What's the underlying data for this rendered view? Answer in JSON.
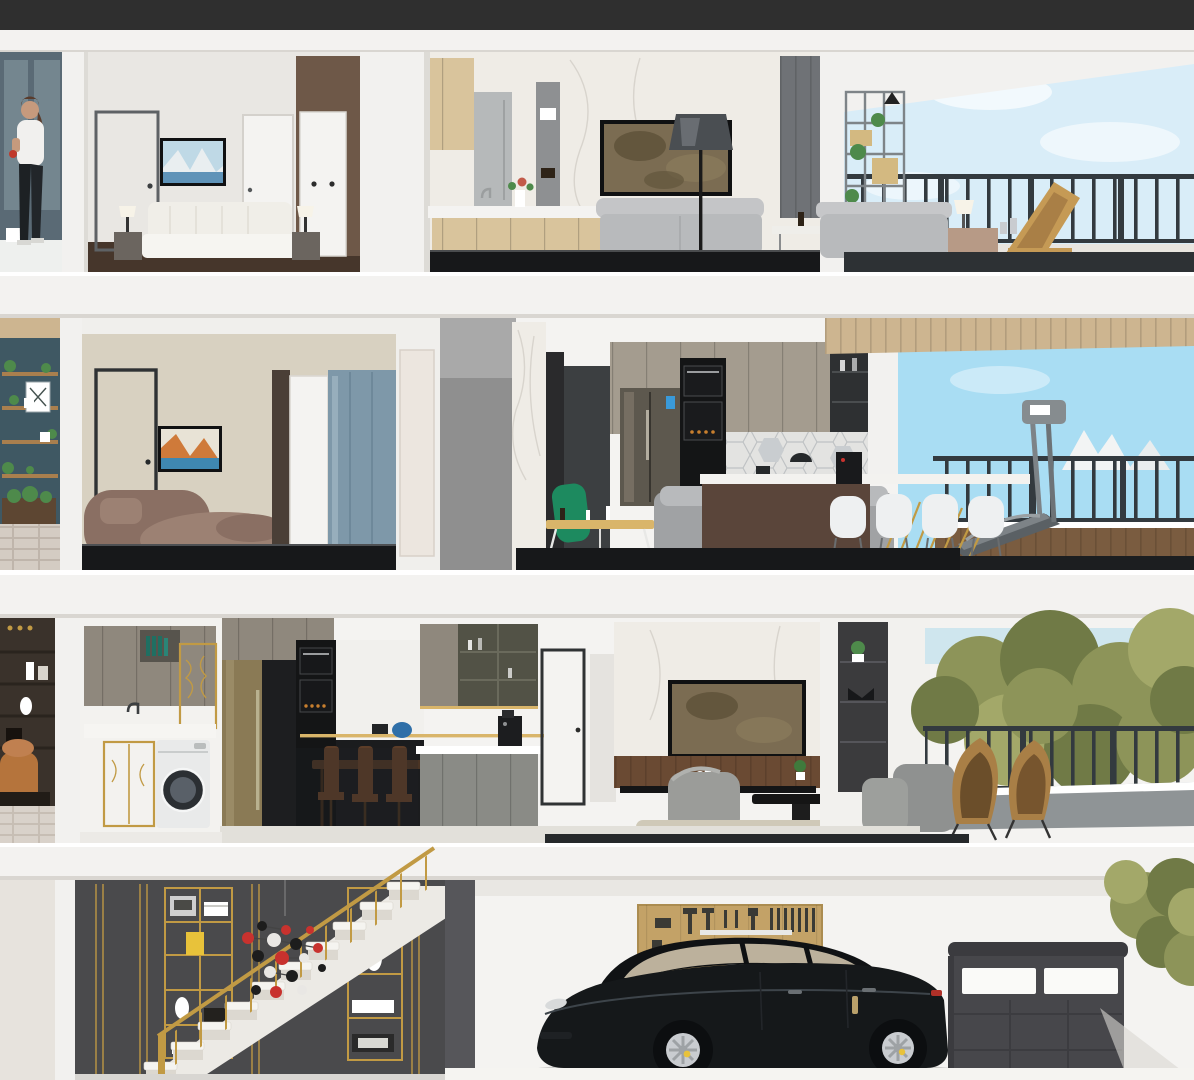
{
  "window": {
    "top_bar_color": "#2f2f2f"
  },
  "scene": {
    "type": "3d-dollhouse-cross-section",
    "description_tag": "four-storey-home-cutaway-render",
    "floors": [
      {
        "level": 4,
        "label": "top-floor",
        "rooms": [
          "bedroom",
          "open-kitchen-living-room",
          "balcony-lounge"
        ],
        "objects": [
          "interior-door-gray",
          "wall-tv-landscape",
          "double-bed",
          "nightstand-lamps",
          "interior-door-white",
          "wardrobe",
          "kitchen-island",
          "living-room-tv",
          "floor-lamp",
          "gray-sofa",
          "media-table",
          "plant-shelf",
          "papasan-chair",
          "blue-pillows",
          "side-table-lamp",
          "rattan-lounger",
          "balcony-railing",
          "sky"
        ]
      },
      {
        "level": 3,
        "label": "second-floor",
        "rooms": [
          "lounge-bedroom",
          "kitchen-dining",
          "fitness-balcony"
        ],
        "objects": [
          "plant-wall-shelves",
          "gray-door",
          "wall-tv-canyon",
          "curved-mauve-sofa",
          "white-closet",
          "blue-cabinet",
          "marble-pillar",
          "fridge",
          "oven-column",
          "hexagon-backsplash",
          "kitchen-island-dark",
          "green-accent-chair",
          "gold-coffee-table",
          "gray-sofa-blue-pillow",
          "white-dining-chairs",
          "coffee-machine",
          "treadmill",
          "balcony-railing",
          "wood-planter",
          "sky"
        ]
      },
      {
        "level": 2,
        "label": "third-floor",
        "rooms": [
          "laundry-room",
          "kitchen-dining",
          "living-room",
          "tree-view-balcony"
        ],
        "objects": [
          "study-shelf-exterior",
          "laundry-cabinets",
          "gold-framed-cabinets",
          "washing-machine",
          "brass-fridge",
          "oven-column",
          "gold-rail",
          "dining-table-wood",
          "olive-glass-cabinets",
          "coffee-machine",
          "marble-tv-wall",
          "living-room-tv",
          "wood-wainscot",
          "gray-armchair",
          "black-coffee-table",
          "beige-rug",
          "display-cabinet",
          "rattan-egg-chairs",
          "balcony-railing",
          "trees"
        ]
      },
      {
        "level": 1,
        "label": "ground-floor",
        "rooms": [
          "stair-hall",
          "garage"
        ],
        "objects": [
          "paneled-dark-wall",
          "gold-etagere-left",
          "gold-etagere-right",
          "white-staircase",
          "gold-handrail",
          "molecule-sculpture",
          "tool-pegboard-wall",
          "red-stool",
          "black-sedan-car",
          "garage-door-with-windows",
          "tree-foliage"
        ]
      }
    ]
  },
  "palette": {
    "topbar": "#2f2f2f",
    "slab": "#f3f2f0",
    "slab_edge": "#d9d6d1",
    "wall_light": "#eae8e4",
    "wall_white": "#f4f3f1",
    "wall_beige": "#d8d1c1",
    "wall_gray": "#8f8f8f",
    "marble": "#efece6",
    "marble_vein": "#d8d4cd",
    "column": "#f2f1ef",
    "column_shade": "#dddbd6",
    "floor_brown": "#46362b",
    "floor_black": "#17181a",
    "floor_tile": "#2d3134",
    "floor_light": "#e2e0da",
    "sky_pale": "#d9edf8",
    "sky_blue": "#a9ddf3",
    "sky_haze": "#cfe6ee",
    "rail": "#333a3f",
    "wood_light": "#d9c49c",
    "wood_soffit": "#cdb590",
    "teal_wall": "#3f5863",
    "brick": "#d4ccc3",
    "brick_line": "#bfb5ab",
    "shelf_wood": "#a97f4e",
    "plant_green": "#4e8a4b",
    "study_brown": "#3a322b",
    "caramel": "#b5743c",
    "door_gray": "#949a9d",
    "door_frame": "#5e6265",
    "frame_dark": "#2f3234",
    "tv_frame": "#101112",
    "tv_blur": "#7b6c52",
    "tv_blur_dark": "#5e5138",
    "mauve": "#8a6f63",
    "mauve_light": "#9c8173",
    "blue_cabinet": "#7e98a9",
    "charcoal": "#3c3f41",
    "taupe": "#a49c8f",
    "taupe_dark": "#8f887d",
    "cab_black": "#141516",
    "hex_tile": "#e3e3e1",
    "hex_line": "#bfc2c4",
    "island_brown": "#5a453a",
    "gold": "#c19a44",
    "gold_light": "#d9b56a",
    "sofa_gray": "#a0a2a4",
    "sofa_gray_light": "#b8babc",
    "pillow_blue": "#2f7cad",
    "pillow_blue2": "#4f74b8",
    "green_chair": "#1d8a5f",
    "chair_white": "#eef0f1",
    "tread_gray": "#7d8387",
    "planter_wood": "#7a5c40",
    "rattan": "#c59a55",
    "rattan_dark": "#a97f46",
    "tree_green": "#8d9459",
    "tree_green_dark": "#707a46",
    "tree_green_light": "#a3a869",
    "stair_wall": "#4a4a4c",
    "stair_wall_dark": "#3a3a3c",
    "step_white": "#f5f4f0",
    "step_shade": "#dcd8d0",
    "tool_wall": "#c3a267",
    "tool_dark": "#3a3a35",
    "accent_red": "#c8322e",
    "car_black": "#15181a",
    "car_dark": "#0c0e10",
    "glass_beige": "#cbbfa8",
    "rim_silver": "#c9ccd0",
    "garage_door": "#47474b",
    "garage_door_dark": "#3b3b3f",
    "washer_white": "#e9eaea",
    "window_slate": "#5a6a75",
    "window_pane": "#74868f",
    "skin": "#c69a7d",
    "hair_brown": "#5a3c2c",
    "white": "#ffffff",
    "orange_rug": "#b0552f",
    "canyon_orange": "#cf7a3a",
    "canyon_blue": "#3f87b0",
    "fridge_gray": "#b6b9ba",
    "fridge_dark": "#5d584e",
    "brass": "#8a7a55",
    "accent_panel": "#6f7276",
    "shelf_gray": "#8e9092",
    "olive_glass": "#525246",
    "lower_gray": "#8a8b86",
    "wainscot": "#6a4a33",
    "rug_beige": "#cfc9b8",
    "armchair_gray": "#9b9c99",
    "cabinet_display": "#3b3b3d",
    "label_blue": "#3a9ad9",
    "amber": "#c87f2e",
    "yellow_book": "#e8c23a",
    "planter_ledge": "#8f9496"
  }
}
